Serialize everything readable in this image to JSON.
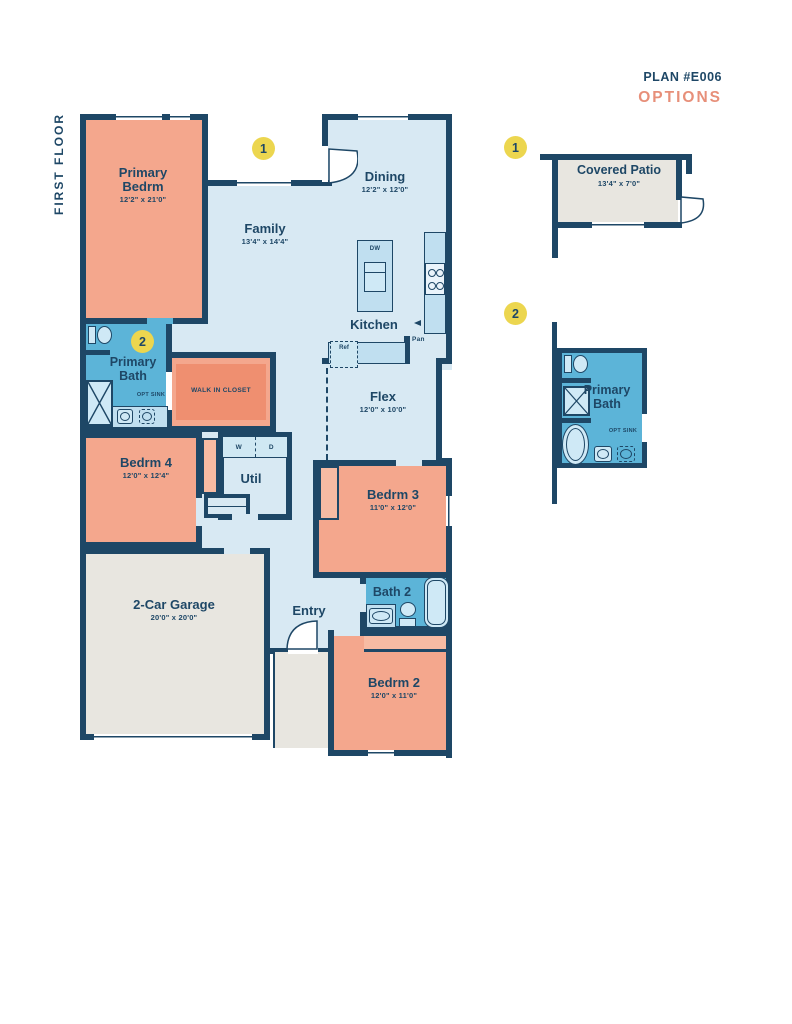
{
  "header": {
    "plan_number": "PLAN #E006",
    "options_title": "OPTIONS"
  },
  "floor_label": "FIRST FLOOR",
  "markers": {
    "m1": "1",
    "m2": "2",
    "opt1": "1",
    "opt2": "2"
  },
  "rooms": {
    "primary_bedrm": {
      "label": "Primary Bedrm",
      "dims": "12'2\" x 21'0\""
    },
    "family": {
      "label": "Family",
      "dims": "13'4\" x 14'4\""
    },
    "dining": {
      "label": "Dining",
      "dims": "12'2\" x 12'0\""
    },
    "kitchen": {
      "label": "Kitchen",
      "dishwasher": "DW",
      "refrigerator": "Ref",
      "pantry": "Pan"
    },
    "primary_bath": {
      "label": "Primary Bath",
      "opt_sink": "OPT SINK"
    },
    "walk_in_closet": {
      "label": "WALK IN CLOSET"
    },
    "bedrm4": {
      "label": "Bedrm 4",
      "dims": "12'0\" x 12'4\""
    },
    "util": {
      "label": "Util",
      "washer": "W",
      "dryer": "D"
    },
    "flex": {
      "label": "Flex",
      "dims": "12'0\" x 10'0\""
    },
    "bedrm3": {
      "label": "Bedrm 3",
      "dims": "11'0\" x 12'0\""
    },
    "bath2": {
      "label": "Bath 2"
    },
    "entry": {
      "label": "Entry"
    },
    "bedrm2": {
      "label": "Bedrm 2",
      "dims": "12'0\" x 11'0\""
    },
    "garage": {
      "label": "2-Car Garage",
      "dims": "20'0\" x 20'0\""
    }
  },
  "options": {
    "covered_patio": {
      "label": "Covered Patio",
      "dims": "13'4\" x 7'0\""
    },
    "primary_bath_option": {
      "label": "Primary Bath",
      "opt_sink": "OPT SINK"
    }
  },
  "colors": {
    "navy": "#1e4766",
    "salmon": "#f4a78d",
    "salmon_light": "#f7bba3",
    "salmon_dark": "#ef8f70",
    "blue_room": "#d8e9f3",
    "blue_counter": "#c0dff0",
    "blue_bath": "#5cb4d8",
    "blue_fixture": "#cfe9f6",
    "gray_room": "#e8e6e0",
    "yellow": "#ecd64f",
    "coral": "#e78f79",
    "bg": "#ffffff"
  }
}
